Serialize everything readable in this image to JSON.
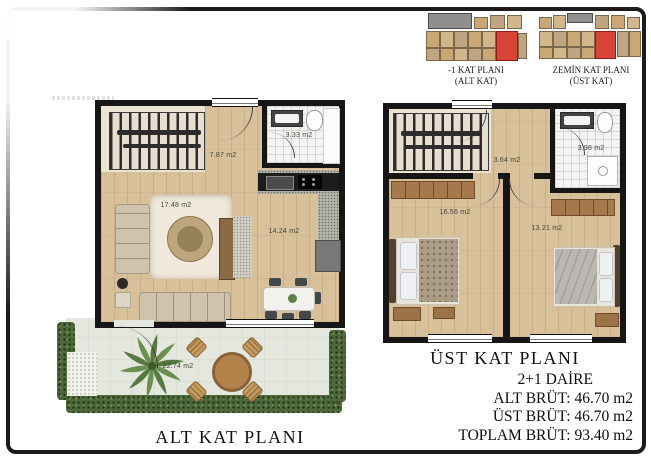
{
  "key_plans": [
    {
      "title": "-1 KAT PLANI",
      "subtitle": "(ALT KAT)"
    },
    {
      "title": "ZEMİN KAT PLANI",
      "subtitle": "(ÜST KAT)"
    }
  ],
  "lower_plan": {
    "label": "ALT KAT PLANI",
    "areas": {
      "hall": "7.87 m2",
      "bathroom": "3.33 m2",
      "living": "17.48 m2",
      "kitchen_dining": "14.24 m2",
      "terrace": "22.74 m2"
    }
  },
  "upper_plan": {
    "label": "ÜST KAT PLANI",
    "areas": {
      "hall": "3.64 m2",
      "bathroom": "3.98 m2",
      "bedroom_1": "16.56 m2",
      "bedroom_2": "13.21 m2"
    }
  },
  "summary": {
    "title": "2+1 DAİRE",
    "lines": [
      "ALT BRÜT: 46.70 m2",
      "ÜST BRÜT: 46.70 m2",
      "TOPLAM BRÜT: 93.40 m2"
    ]
  },
  "colors": {
    "highlight_red": "#cf3a2d",
    "wood": "#d8c09b",
    "wall": "#161616",
    "terrace_floor": "#e3e7dd",
    "hedge_green": "#4d683a"
  }
}
